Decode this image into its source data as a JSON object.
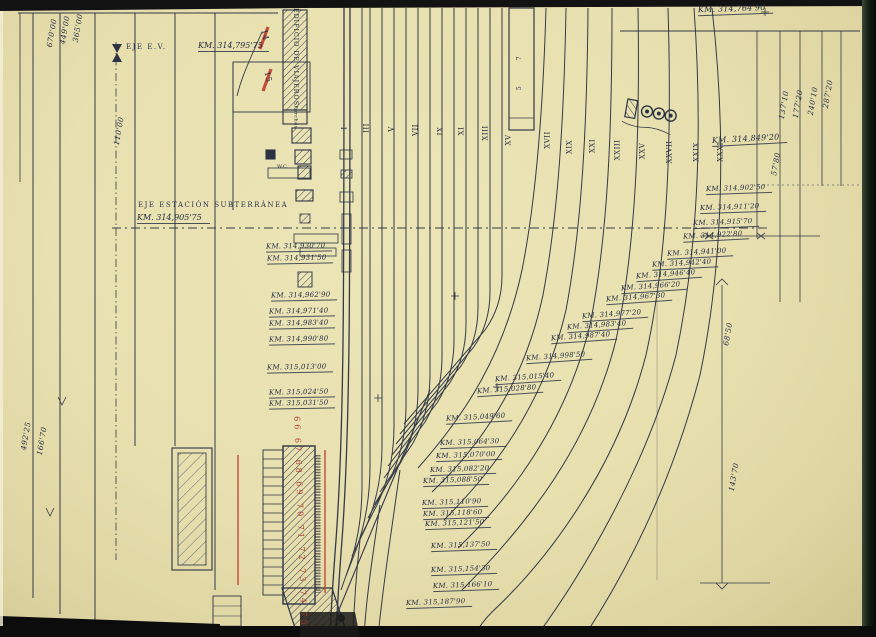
{
  "meta": {
    "drawing_type": "railway track layout blueprint (scanned)"
  },
  "colors": {
    "paper": "#e9e2b4",
    "ink": "#2c3344",
    "red": "#c23b2e"
  },
  "top": {
    "corner_km": "KM. 314,764'90",
    "eje_ev_label": "EJE  E.V.",
    "eje_ev_km": "KM. 314,795'75",
    "red_mark_upper": "14",
    "red_mark_lower": "15",
    "building_label": "EDIFICIO DE VIAJEROS",
    "porches_label": "Porches",
    "wc_label": "W.C."
  },
  "axis": {
    "label": "EJE ESTACIÓN SUBTERRÁNEA",
    "km": "KM. 314,905'75"
  },
  "dimensions_left": [
    "670'00",
    "449'00",
    "365'00",
    "110'00",
    "492'25",
    "166'70"
  ],
  "dimensions_right": [
    "287'20",
    "240'10",
    "177'20",
    "137'10",
    "57'80",
    "68'50",
    "143'70"
  ],
  "track_numbers": [
    "I",
    "III",
    "V",
    "VII",
    "IX",
    "XI",
    "XIII",
    "XV",
    "XVII",
    "XIX",
    "XXI",
    "XXIII",
    "XXV",
    "XXVII",
    "XXIX",
    "XXXI"
  ],
  "platform_numbers": [
    "7",
    "5"
  ],
  "km_column_left": [
    "KM. 314,930'70",
    "KM. 314,931'50",
    "KM. 314,962'90",
    "KM. 314,971'40",
    "KM. 314,983'40",
    "KM. 314,990'80",
    "KM. 315,013'00",
    "KM. 315,024'50",
    "KM. 315,031'50"
  ],
  "km_annotations": [
    "KM. 314,764'90",
    "KM. 314,849'20",
    "KM. 314,902'50",
    "KM. 314,911'20",
    "KM. 314,915'70",
    "KM. 314,922'80",
    "KM. 314,941'00",
    "KM. 314,942'40",
    "KM. 314,946'40",
    "KM. 314,966'20",
    "KM. 314,967'30",
    "KM. 314,977'20",
    "KM. 314,983'40",
    "KM. 314,987'40",
    "KM. 314,998'50",
    "KM. 315,015'40",
    "KM. 315,028'80",
    "KM. 315,049'60",
    "KM. 315,064'30",
    "KM. 315,070'00",
    "KM. 315,082'20",
    "KM. 315,088'50",
    "KM. 315,110'90",
    "KM. 315,118'60",
    "KM. 315,121'50",
    "KM. 315,137'50",
    "KM. 315,154'30",
    "KM. 315,166'10",
    "KM. 315,187'90"
  ],
  "red_numbers": "66 67 68 69 70 71 72 73 74 75"
}
